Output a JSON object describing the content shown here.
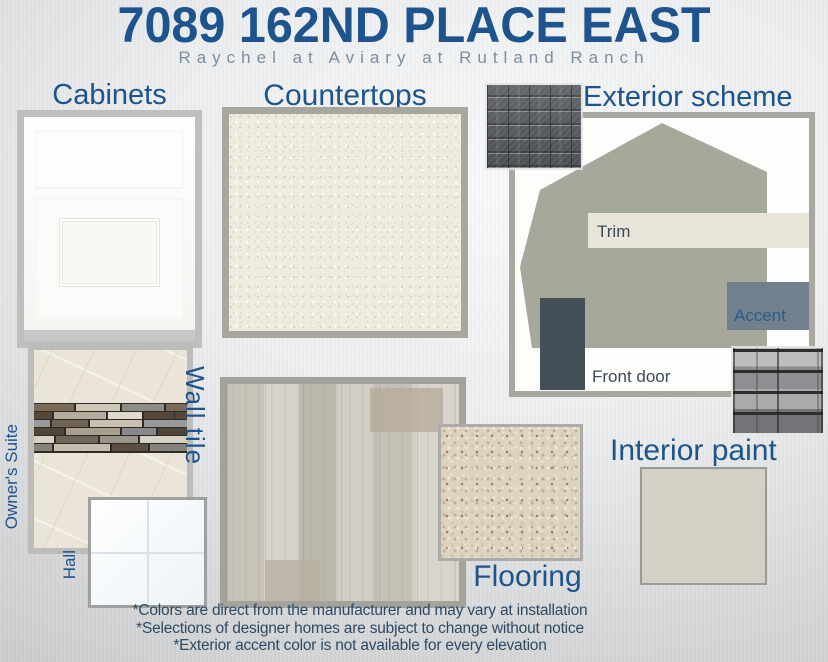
{
  "header": {
    "title": "7089 162ND PLACE EAST",
    "subtitle": "Raychel at Aviary at Rutland Ranch"
  },
  "sections": {
    "cabinets": {
      "heading": "Cabinets",
      "sample": "white-shaker-cabinet"
    },
    "countertops": {
      "heading": "Countertops",
      "sample_color": "#efecdf"
    },
    "exterior_scheme": {
      "heading": "Exterior scheme",
      "labels": {
        "trim": "Trim",
        "accent": "Accent",
        "front_door": "Front door"
      },
      "swatch_colors": {
        "body": "#a5a89b",
        "trim": "#e9e6d9",
        "accent": "#70808d",
        "front_door": "#454f58"
      },
      "samples": {
        "roof": "dark-gray-shingle",
        "stone": "gray-ledger-stone"
      }
    },
    "wall_tile": {
      "heading": "Wall tile",
      "rooms": {
        "owners_suite": "Owner's Suite",
        "hall": "Hall"
      },
      "samples": {
        "owners_suite": "cream-marble-with-mosaic-accent-strip",
        "hall": "white-gloss-tile"
      }
    },
    "flooring": {
      "heading": "Flooring",
      "samples": {
        "plank": "greige-wood-plank",
        "carpet": "beige-carpet"
      }
    },
    "interior_paint": {
      "heading": "Interior paint",
      "swatch_color": "#d5d0c6"
    }
  },
  "footnotes": [
    "*Colors are direct from the manufacturer and may vary at installation",
    "*Selections of designer homes are subject to change without notice",
    "*Exterior accent color is not available for every elevation"
  ],
  "colors": {
    "title_blue": "#1d548d",
    "subtitle_gray": "#7b8ea1",
    "heading_blue": "#1e548c",
    "label_slate": "#3d4a55",
    "footnote_blue": "#2d4964"
  }
}
